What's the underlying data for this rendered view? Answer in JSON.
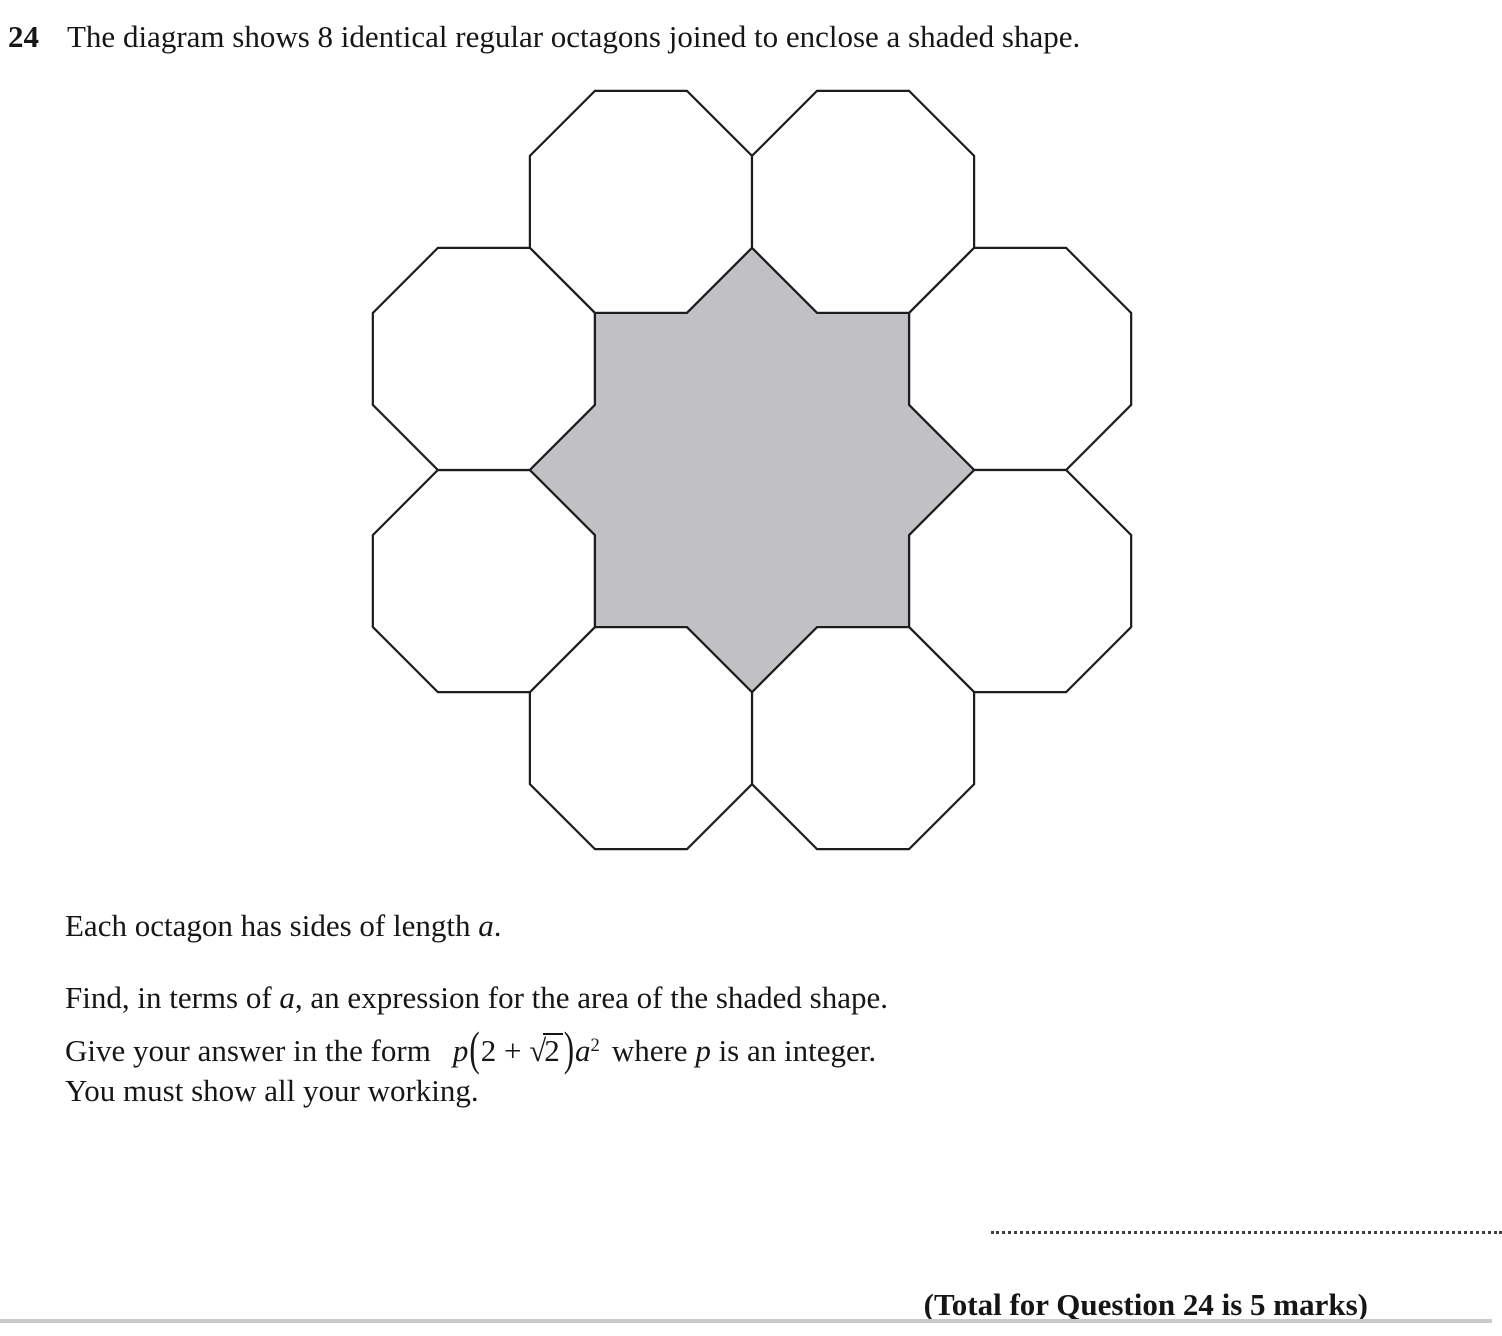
{
  "question": {
    "number": "24",
    "prompt": "The diagram shows 8 identical regular octagons joined to enclose a shaded shape."
  },
  "statements": {
    "s1_pre": "Each octagon has sides of length ",
    "s1_var": "a",
    "s1_post": ".",
    "s2_pre": "Find, in terms of ",
    "s2_var": "a",
    "s2_post": ", an expression for the area of the shaded shape.",
    "s3_pre": "Give your answer in the form",
    "s3_mid": "where ",
    "s3_var": "p",
    "s3_post": " is an integer.",
    "s4": "You must show all your working."
  },
  "formula": {
    "coeff": "p",
    "lparen": "(",
    "inner_pre": "2 + ",
    "radical": "√",
    "radicand": "2",
    "rparen": ")",
    "variable": "a",
    "exponent": "2"
  },
  "footer": {
    "total_label": "(Total for Question 24 is 5 marks)"
  },
  "diagram": {
    "octagon_count": 8,
    "shaded_shape": "eight-pointed star",
    "shaded_fill": "#c1c1c3",
    "outline_color": "#1d1d1f",
    "outline_width": 2.2
  }
}
